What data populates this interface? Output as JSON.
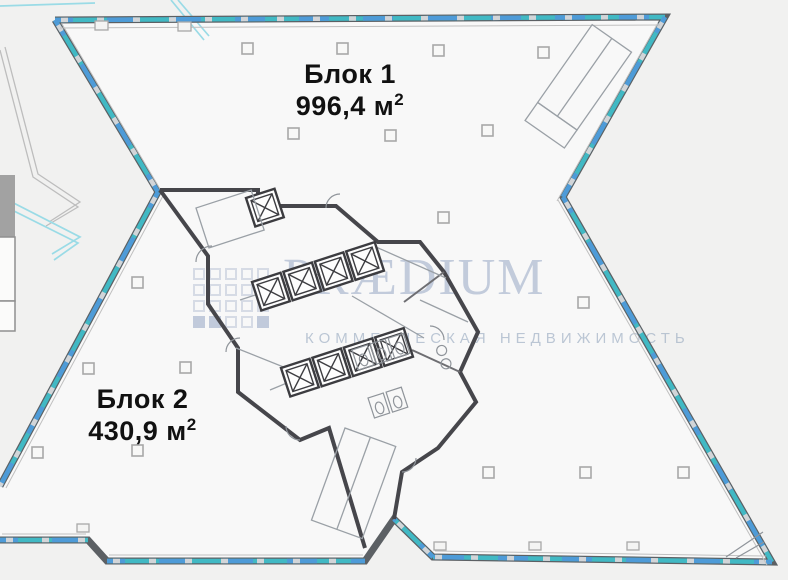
{
  "plan": {
    "block1": {
      "name": "Блок 1",
      "area_value": "996,4 м",
      "area_sup": "2"
    },
    "block2": {
      "name": "Блок 2",
      "area_value": "430,9 м",
      "area_sup": "2"
    }
  },
  "watermark": {
    "brand": "PRÆDIUM",
    "tagline": "КОММЕРЧЕСКАЯ НЕДВИЖИМОСТЬ"
  },
  "colors": {
    "background": "#f1f1f0",
    "wall": "#5c6064",
    "core_wall": "#46464b",
    "window_teal": "#41b9c4",
    "window_blue": "#4e9bd8",
    "window_gray": "#d2d5d8",
    "watermark": "#a9b7cf",
    "tagline": "#9fafc4",
    "label": "#111111",
    "legend_gray": "#a2a2a2",
    "line_cyan": "#9adbe6",
    "line_gray": "#bdbdbd"
  }
}
